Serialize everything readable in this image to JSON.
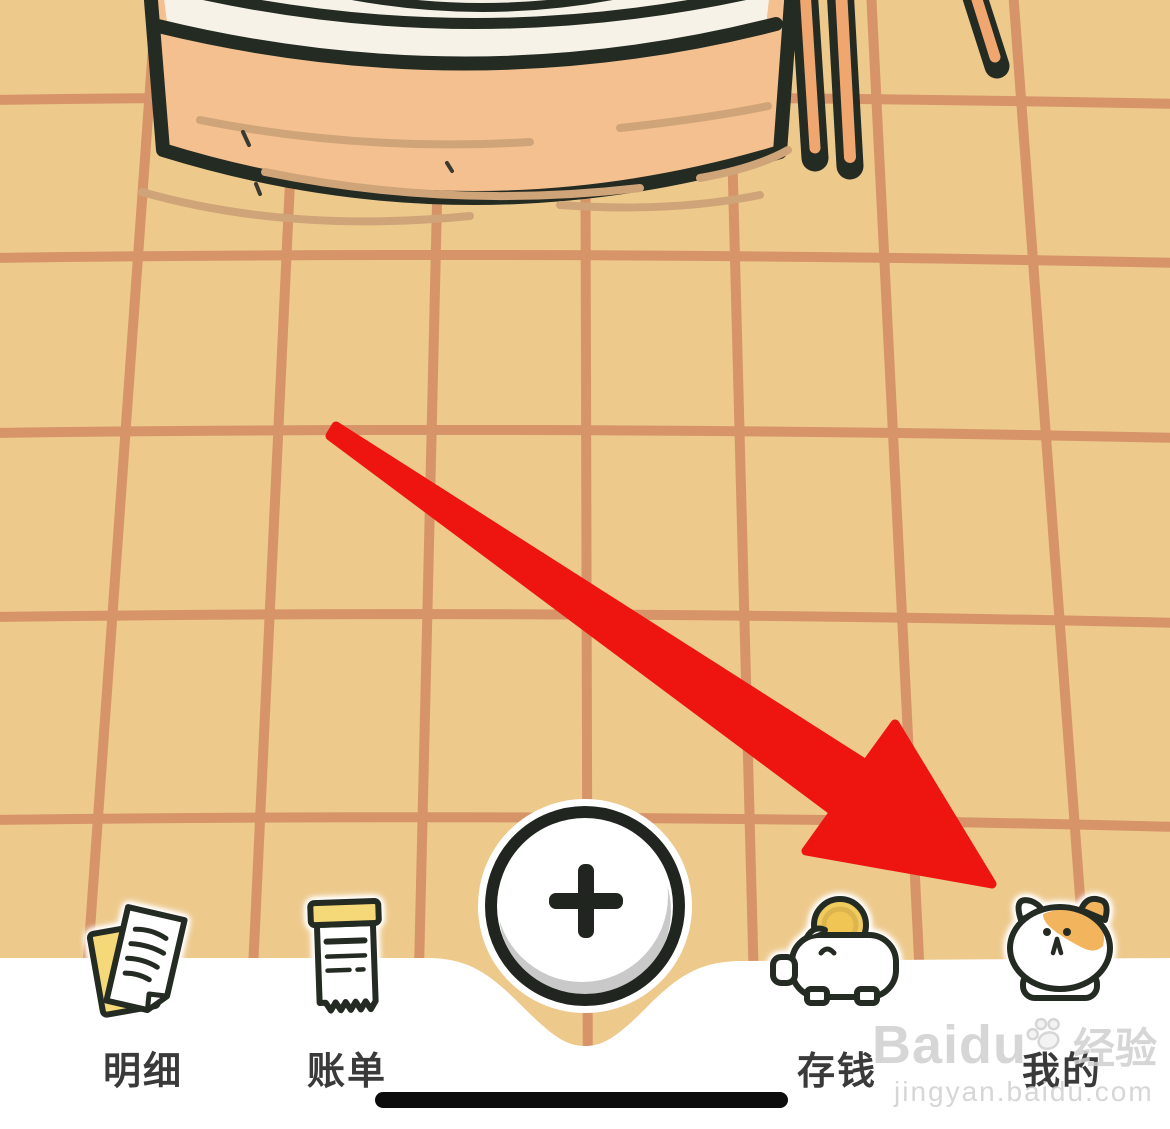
{
  "nav": {
    "items": [
      {
        "id": "details",
        "label": "明细"
      },
      {
        "id": "bills",
        "label": "账单"
      },
      {
        "id": "savings",
        "label": "存钱"
      },
      {
        "id": "profile",
        "label": "我的"
      }
    ],
    "add_button_symbol": "+"
  },
  "watermark": {
    "brand": "Baidu",
    "suffix": "经验",
    "url": "jingyan.baidu.com"
  },
  "colors": {
    "bg": "#edc98c",
    "grid": "#d79468",
    "outline": "#242b23",
    "steamer": "#f4c08f",
    "steamer_top": "#f6f2e7",
    "grain": "#cfa478",
    "stick": "#f0a76f",
    "arrow": "#ee1410",
    "navbar": "#ffffff",
    "accent_yellow": "#f5d878",
    "coin": "#f0cb5e",
    "cat_patch": "#f3b45e",
    "label_text": "#3a3a3a",
    "button_shadow": "#c9c9c9",
    "watermark_gray": "#d0d0d0"
  }
}
